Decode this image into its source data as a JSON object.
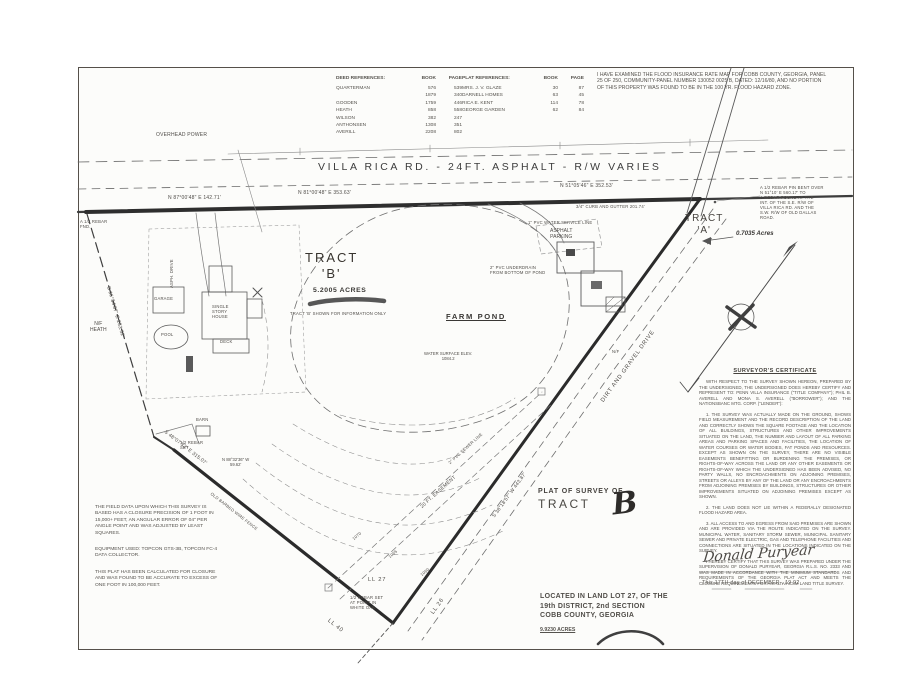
{
  "tables": {
    "deed": {
      "title": "DEED REFERENCES:",
      "col_book": "BOOK",
      "col_page": "PAGE",
      "rows": [
        [
          "QUARTERMAN",
          "576",
          "539"
        ],
        [
          "",
          "1879",
          "340"
        ],
        [
          "GOODEN",
          "1759",
          "446"
        ],
        [
          "HEATH",
          "858",
          "558"
        ],
        [
          "WILSON",
          "382",
          "247"
        ],
        [
          "ANTHONSEN",
          "1308",
          "351"
        ],
        [
          "AVERILL",
          "2208",
          "802"
        ]
      ]
    },
    "plat": {
      "title": "PLAT REFERENCES:",
      "col_book": "BOOK",
      "col_page": "PAGE",
      "rows": [
        [
          "MRS. J. V. GLAZE",
          "30",
          "87"
        ],
        [
          "DARNELL HOMES",
          "63",
          "45"
        ],
        [
          "RICA E. KENT",
          "114",
          "78"
        ],
        [
          "GEORGE GARDEN",
          "62",
          "84"
        ]
      ]
    }
  },
  "flood_note": "I HAVE EXAMINED THE FLOOD INSURANCE RATE MAP FOR COBB COUNTY, GEORGIA, PANEL 25 OF 250, COMMUNITY-PANEL NUMBER 130052 0025 B, DATED: 12/16/80, AND NO PORTION OF THIS PROPERTY WAS FOUND TO BE IN THE 100 YR. FLOOD HAZARD ZONE.",
  "certificate": {
    "title": "SURVEYOR'S CERTIFICATE",
    "paragraphs": [
      "WITH RESPECT TO THE SURVEY SHOWN HEREON, PREPARED BY THE UNDERSIGNED, THE UNDERSIGNED DOES HEREBY CERTIFY AND REPRESENT TO: PENN VILLA INSURANCE (\"TITLE COMPANY\"); PHIL B. AVERELL AND MONA S. AVERELL (\"BORROWER\"); AND THE NATIONSBANC MTG. CORP. (\"LENDER\"):",
      "1.  THE SURVEY WAS ACTUALLY MADE ON THE GROUND, SHOWS FIELD MEASUREMENT AND THE RECORD DESCRIPTION OF THE LAND AND CORRECTLY SHOWS THE SQUARE FOOTAGE AND THE LOCATION OF ALL BUILDINGS, STRUCTURES AND OTHER IMPROVEMENTS SITUATED ON THE LAND, THE NUMBER AND LAYOUT OF ALL PARKING AREAS AND PARKING SPACES AND FACILITIES, THE LOCATION OF WATER COURSES OR WATER BODIES, FAT PONDS AND RESOURCES. EXCEPT AS SHOWN ON THE SURVEY, THERE ARE NO VISIBLE EASEMENTS BENEFITTING OR BURDENING THE PREMISES, OR RIGHTS-OF-WAY ACROSS THE LAND OR ANY OTHER EASEMENTS OR RIGHTS-OF-WAY WHICH THE UNDERSIGNED HAS BEEN ADVISED, NO PARTY WALLS, NO ENCROACHMENTS ON ADJOINING PREMISES, STREETS OR ALLEYS BY ANY OF THE LAND OR ANY ENCROACHMENTS FROM ADJOINING PREMISES BY BUILDINGS, STRUCTURES OR OTHER IMPROVEMENTS SITUATED ON ADJOINING PREMISES EXCEPT AS SHOWN.",
      "2.  THE LAND DOES NOT LIE WITHIN A FEDERALLY DESIGNATED FLOOD HAZARD AREA.",
      "3.  ALL ACCESS TO AND EGRESS FROM SAID PREMISES ARE SHOWN AND ARE PROVIDED VIA THE ROUTE INDICATED ON THE SURVEY. MUNICIPAL WATER, SANITARY STORM SEWER, MUNICIPAL SANITARY SEWER AND PRIVATE ELECTRIC, GAS AND TELEPHONE FACILITIES AND CONNECTIONS ARE SITUATED IN THE LOCATIONS INDICATED ON THE SURVEY.",
      "I HEREBY CERTIFY THAT THIS SURVEY WAS PREPARED UNDER THE SUPERVISION OF DONALD PURYEAR, GEORGIA R.L.S. NO. 2333 AND WAS MADE IN ACCORDANCE WITH THE MINIMUM STANDARDS AND REQUIREMENTS OF THE GEORGIA PLAT ACT AND MEETS THE CLOSURE REQUIREMENTS FOR AN ALTA/ACSM LAND TITLE SURVEY."
    ],
    "signature": "Donald Puryear",
    "date_line": "This  17TH   day of   DECEMBER   ,  19 92"
  },
  "notes": [
    "THE FIELD DATA UPON WHICH THIS SURVEY IS BASED HAS A CLOSURE PRECISION OF 1 FOOT IN 15,000+ FEET, AN ANGULAR ERROR OF 04\" PER ANGLE POINT AND WAS ADJUSTED BY LEAST SQUARES.",
    "EQUIPMENT USED: TOPCON GTS-3B, TOPCON FC-4 DATA COLLECTOR.",
    "THIS PLAT HAS BEEN CALCULATED FOR CLOSURE AND WAS FOUND TO BE ACCURATE TO EXCESS OF ONE FOOT IN 100,000 FEET."
  ],
  "title_block": {
    "line1": "PLAT OF SURVEY OF",
    "line2": "TRACT",
    "handwritten": "B"
  },
  "location_block": {
    "lines": [
      "LOCATED IN LAND LOT 27, OF THE",
      "19th DISTRICT, 2nd SECTION",
      "COBB COUNTY, GEORGIA"
    ],
    "acreage": "9.9230 ACRES"
  },
  "map_labels": [
    {
      "name": "overhead-power",
      "text": "OVERHEAD POWER",
      "x": 156,
      "y": 133,
      "cls": "t4"
    },
    {
      "name": "road-name",
      "text": "VILLA RICA RD.  -  24FT.  ASPHALT  -  R/W VARIES",
      "x": 318,
      "y": 161,
      "cls": "road"
    },
    {
      "name": "bearing-road-left",
      "text": "N 87°00'48\" E   142.71'",
      "x": 168,
      "y": 196,
      "cls": "t4"
    },
    {
      "name": "bearing-road-mid",
      "text": "N 81°00'48\" E   353.63'",
      "x": 298,
      "y": 191,
      "cls": "t4"
    },
    {
      "name": "bearing-road-right",
      "text": "N 51°05'46\" E   352.53'",
      "x": 560,
      "y": 184,
      "cls": "t4"
    },
    {
      "name": "curb-gutter",
      "text": "3/4\" CURB AND GUTTER  201.74'",
      "x": 576,
      "y": 205,
      "cls": "t3"
    },
    {
      "name": "water-service",
      "text": "1\" PVC WATER SERVICE LINE",
      "x": 528,
      "y": 221,
      "cls": "t3"
    },
    {
      "name": "rebar-found",
      "text": "A 1/2 REBAR\nFND.",
      "x": 80,
      "y": 220,
      "cls": "t3"
    },
    {
      "name": "nf-heath",
      "text": "N/F\nHEATH",
      "x": 90,
      "y": 322,
      "cls": "t4c"
    },
    {
      "name": "tract-b",
      "text": "TRACT\n'B'",
      "x": 305,
      "y": 250,
      "cls": "tract"
    },
    {
      "name": "tract-b-acres",
      "text": "5.2005 ACRES",
      "x": 313,
      "y": 287,
      "cls": "t6b"
    },
    {
      "name": "tract-b-note",
      "text": "TRACT 'B' SHOWN FOR INFORMATION ONLY",
      "x": 290,
      "y": 312,
      "cls": "t3"
    },
    {
      "name": "farm-pond",
      "text": "FARM POND",
      "x": 446,
      "y": 313,
      "cls": "t7u"
    },
    {
      "name": "water-elevation",
      "text": "WATER SURFACE ELEV.\n1084.2",
      "x": 424,
      "y": 352,
      "cls": "t3c"
    },
    {
      "name": "pond-underdrain",
      "text": "2\" PVC UNDERDRAIN\nFROM BOTTOM OF POND",
      "x": 490,
      "y": 266,
      "cls": "t3"
    },
    {
      "name": "asphalt-parking",
      "text": "ASPHALT\nPARKING",
      "x": 550,
      "y": 229,
      "cls": "t4c"
    },
    {
      "name": "tract-a",
      "text": "TRACT\n'A'",
      "x": 685,
      "y": 213,
      "cls": "tracta"
    },
    {
      "name": "tract-a-acres",
      "text": "0.7035 Acres",
      "x": 736,
      "y": 230,
      "cls": "t5i"
    },
    {
      "name": "rebar-bent-note",
      "text": "A 1/2 REBAR PIN BENT OVER\nN 51°10' E  560.17' TO\nA REBAR FOUND AT THE\nINT. OF THE S.E. R/W OF\nVILLA RICA RD. AND THE\nS.W. R/W OF OLD DALLAS\nROAD.",
      "x": 760,
      "y": 186,
      "cls": "t3"
    },
    {
      "name": "dirt-gravel-drive",
      "text": "DIRT AND GRAVEL DRIVE",
      "x": 600,
      "y": 400,
      "rot": -54,
      "cls": "t5"
    },
    {
      "name": "bearing-drive",
      "text": "S 38°18'57\" W   443.87'",
      "x": 492,
      "y": 516,
      "rot": -54,
      "cls": "t4"
    },
    {
      "name": "easement",
      "text": "20 FT. EASEMENT",
      "x": 420,
      "y": 506,
      "rot": -42,
      "cls": "t4"
    },
    {
      "name": "sewer-line",
      "text": "2\" PVC SEWER LINE",
      "x": 448,
      "y": 462,
      "rot": -42,
      "cls": "t3"
    },
    {
      "name": "bearing-west",
      "text": "S 16°34'07\" E   233.52'",
      "x": 110,
      "y": 286,
      "rot": 74,
      "cls": "t4"
    },
    {
      "name": "fence-label",
      "text": "OLD BARBED WIRE FENCE",
      "x": 212,
      "y": 492,
      "rot": 38,
      "cls": "t3"
    },
    {
      "name": "bearing-southwest",
      "text": "S 48°07'33\" E   315.07'",
      "x": 166,
      "y": 430,
      "rot": 38,
      "cls": "t4"
    },
    {
      "name": "bearing-jog",
      "text": "N 88°32'36\" W\n59.62'",
      "x": 222,
      "y": 458,
      "cls": "t3c"
    },
    {
      "name": "rebar-set",
      "text": "1/2 REBAR\nSET",
      "x": 180,
      "y": 441,
      "cls": "t3"
    },
    {
      "name": "land-lot-27",
      "text": "LL 27",
      "x": 368,
      "y": 577,
      "cls": "t5"
    },
    {
      "name": "land-lot-40",
      "text": "LL 40",
      "x": 330,
      "y": 618,
      "rot": 38,
      "cls": "t5"
    },
    {
      "name": "land-lot-26",
      "text": "LL 26",
      "x": 430,
      "y": 612,
      "rot": -54,
      "cls": "t5"
    },
    {
      "name": "vertex-note",
      "text": "1/2 REBAR SET\nAT POINT IN\nWHITE OAK",
      "x": 350,
      "y": 596,
      "cls": "t3"
    },
    {
      "name": "garage",
      "text": "GARAGE",
      "x": 154,
      "y": 297,
      "cls": "t3"
    },
    {
      "name": "house",
      "text": "SINGLE\nSTORY\nHOUSE",
      "x": 212,
      "y": 305,
      "cls": "t3"
    },
    {
      "name": "deck",
      "text": "DECK",
      "x": 220,
      "y": 340,
      "cls": "t3"
    },
    {
      "name": "pool",
      "text": "POOL",
      "x": 161,
      "y": 333,
      "cls": "t3"
    },
    {
      "name": "barn",
      "text": "BARN",
      "x": 196,
      "y": 418,
      "cls": "t3"
    },
    {
      "name": "asphalt-drive",
      "text": "ASPH. DRIVE",
      "x": 170,
      "y": 288,
      "rot": -90,
      "cls": "t3"
    },
    {
      "name": "nf-east",
      "text": "N/F",
      "x": 612,
      "y": 350,
      "cls": "t3"
    },
    {
      "name": "contour-1070",
      "text": "1070",
      "x": 352,
      "y": 538,
      "rot": -40,
      "cls": "t3"
    },
    {
      "name": "contour-1065",
      "text": "1065",
      "x": 388,
      "y": 556,
      "rot": -40,
      "cls": "t3"
    },
    {
      "name": "contour-1060",
      "text": "1060",
      "x": 420,
      "y": 574,
      "rot": -40,
      "cls": "t3"
    }
  ]
}
